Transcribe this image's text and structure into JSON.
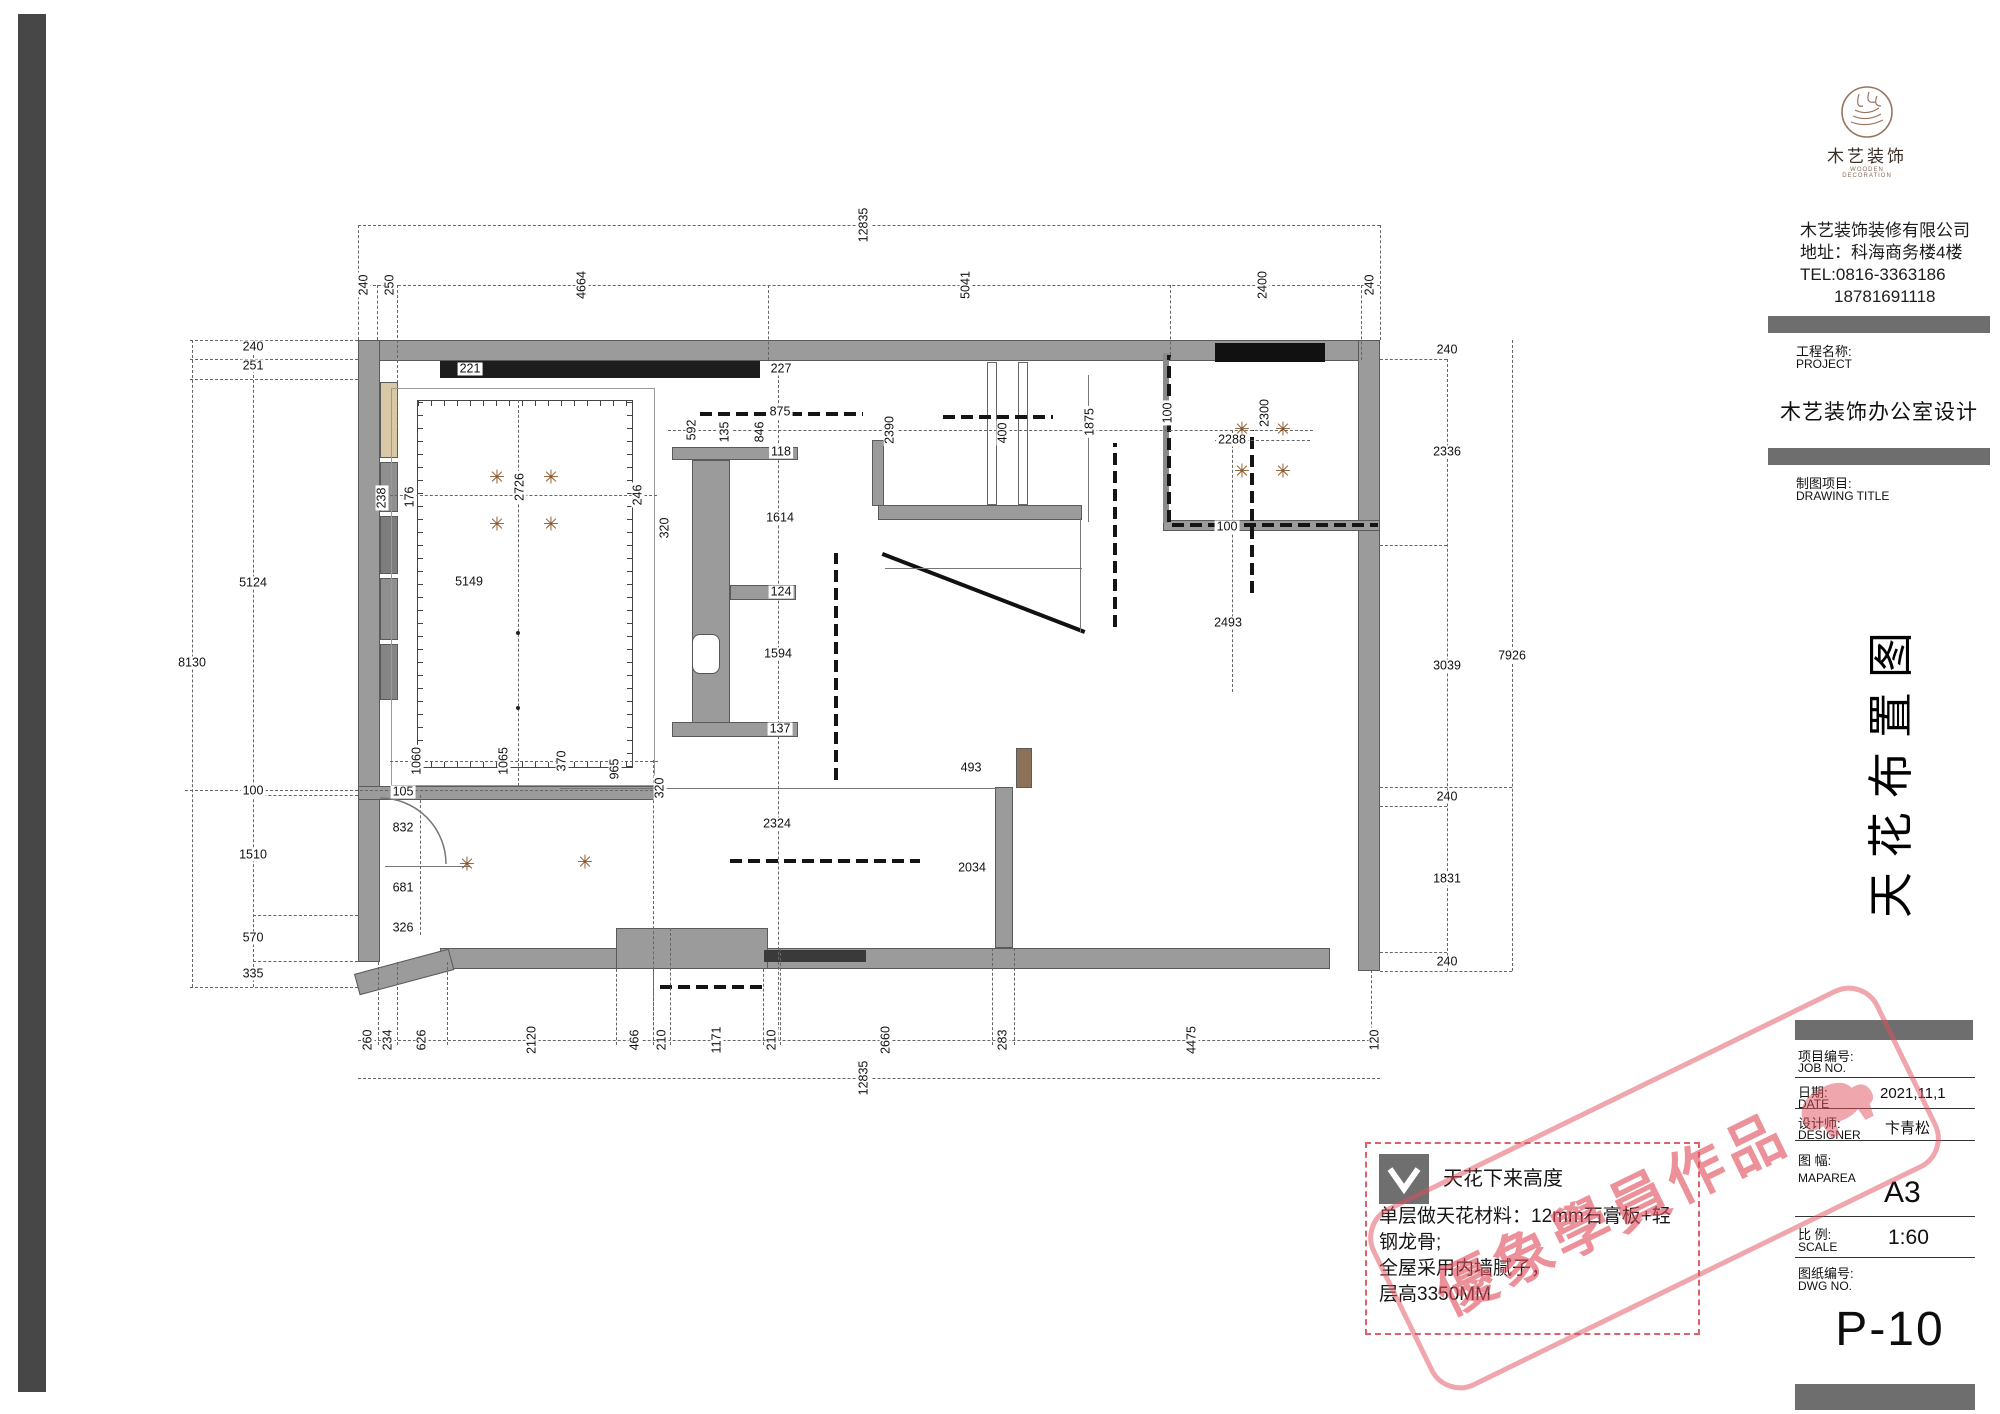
{
  "company": {
    "logo_cn": "木艺装饰",
    "logo_en": "WOODEN DECORATION",
    "full_name": "木艺装饰装修有限公司",
    "address": "地址：科海商务楼4楼",
    "tel": "TEL:0816-3363186",
    "tel2": "18781691118"
  },
  "title_block": {
    "project_label_cn": "工程名称:",
    "project_label_en": "PROJECT",
    "project_name": "木艺装饰办公室设计",
    "drawing_label_cn": "制图项目:",
    "drawing_label_en": "DRAWING TITLE",
    "drawing_title_vertical": "天花布置图",
    "rows": [
      {
        "cn": "项目编号:",
        "en": "JOB NO.",
        "value": ""
      },
      {
        "cn": "日期:",
        "en": "DATE",
        "value": "2021,11,1"
      },
      {
        "cn": "设计师:",
        "en": "DESIGNER",
        "value": "卞青松"
      },
      {
        "cn": "图 幅:",
        "en": "MAPAREA",
        "value": "A3"
      },
      {
        "cn": "比 例:",
        "en": "SCALE",
        "value": "1:60"
      },
      {
        "cn": "图纸编号:",
        "en": "DWG NO.",
        "value": ""
      }
    ],
    "sheet_number": "P-10"
  },
  "legend": {
    "item1": "天花下来高度",
    "note1": "单层做天花材料：12mm石膏板+轻钢龙骨;",
    "note2": "全屋采用内墙腻子，",
    "note3": "层高3350MM"
  },
  "watermark": {
    "text": "優象學員作品"
  },
  "plan": {
    "dims": [
      {
        "t": "12835",
        "x": 864,
        "y": 225,
        "r": 1
      },
      {
        "t": "240",
        "x": 364,
        "y": 285,
        "r": 1
      },
      {
        "t": "250",
        "x": 390,
        "y": 285,
        "r": 1
      },
      {
        "t": "4664",
        "x": 582,
        "y": 285,
        "r": 1
      },
      {
        "t": "5041",
        "x": 966,
        "y": 285,
        "r": 1
      },
      {
        "t": "2400",
        "x": 1263,
        "y": 285,
        "r": 1
      },
      {
        "t": "240",
        "x": 1370,
        "y": 285,
        "r": 1
      },
      {
        "t": "8130",
        "x": 192,
        "y": 663,
        "r": 0
      },
      {
        "t": "240",
        "x": 253,
        "y": 347,
        "r": 0
      },
      {
        "t": "251",
        "x": 253,
        "y": 366,
        "r": 0
      },
      {
        "t": "5124",
        "x": 253,
        "y": 583,
        "r": 0
      },
      {
        "t": "100",
        "x": 253,
        "y": 791,
        "r": 0
      },
      {
        "t": "1510",
        "x": 253,
        "y": 855,
        "r": 0
      },
      {
        "t": "570",
        "x": 253,
        "y": 938,
        "r": 0
      },
      {
        "t": "335",
        "x": 253,
        "y": 974,
        "r": 0
      },
      {
        "t": "7926",
        "x": 1512,
        "y": 656,
        "r": 0
      },
      {
        "t": "240",
        "x": 1447,
        "y": 350,
        "r": 0
      },
      {
        "t": "2336",
        "x": 1447,
        "y": 452,
        "r": 0
      },
      {
        "t": "3039",
        "x": 1447,
        "y": 666,
        "r": 0
      },
      {
        "t": "240",
        "x": 1447,
        "y": 797,
        "r": 0
      },
      {
        "t": "1831",
        "x": 1447,
        "y": 879,
        "r": 0
      },
      {
        "t": "240",
        "x": 1447,
        "y": 962,
        "r": 0
      },
      {
        "t": "260",
        "x": 368,
        "y": 1040,
        "r": 1
      },
      {
        "t": "234",
        "x": 388,
        "y": 1040,
        "r": 1
      },
      {
        "t": "626",
        "x": 422,
        "y": 1040,
        "r": 1
      },
      {
        "t": "2120",
        "x": 532,
        "y": 1040,
        "r": 1
      },
      {
        "t": "466",
        "x": 635,
        "y": 1040,
        "r": 1
      },
      {
        "t": "210",
        "x": 662,
        "y": 1040,
        "r": 1
      },
      {
        "t": "1171",
        "x": 717,
        "y": 1040,
        "r": 1
      },
      {
        "t": "210",
        "x": 772,
        "y": 1040,
        "r": 1
      },
      {
        "t": "2660",
        "x": 886,
        "y": 1040,
        "r": 1
      },
      {
        "t": "283",
        "x": 1003,
        "y": 1040,
        "r": 1
      },
      {
        "t": "4475",
        "x": 1192,
        "y": 1040,
        "r": 1
      },
      {
        "t": "120",
        "x": 1375,
        "y": 1040,
        "r": 1
      },
      {
        "t": "12835",
        "x": 864,
        "y": 1078,
        "r": 1
      },
      {
        "t": "221",
        "x": 470,
        "y": 369,
        "r": 0
      },
      {
        "t": "227",
        "x": 781,
        "y": 369,
        "r": 0
      },
      {
        "t": "875",
        "x": 780,
        "y": 412,
        "r": 0
      },
      {
        "t": "592",
        "x": 692,
        "y": 430,
        "r": 1
      },
      {
        "t": "135",
        "x": 725,
        "y": 432,
        "r": 1
      },
      {
        "t": "846",
        "x": 760,
        "y": 432,
        "r": 1
      },
      {
        "t": "118",
        "x": 781,
        "y": 452,
        "r": 0
      },
      {
        "t": "2390",
        "x": 890,
        "y": 430,
        "r": 1
      },
      {
        "t": "400",
        "x": 1003,
        "y": 433,
        "r": 1
      },
      {
        "t": "1875",
        "x": 1090,
        "y": 422,
        "r": 1
      },
      {
        "t": "100",
        "x": 1168,
        "y": 413,
        "r": 1
      },
      {
        "t": "2300",
        "x": 1265,
        "y": 413,
        "r": 1
      },
      {
        "t": "2288",
        "x": 1232,
        "y": 440,
        "r": 0
      },
      {
        "t": "2726",
        "x": 520,
        "y": 487,
        "r": 1
      },
      {
        "t": "238",
        "x": 382,
        "y": 498,
        "r": 1
      },
      {
        "t": "176",
        "x": 410,
        "y": 497,
        "r": 1
      },
      {
        "t": "246",
        "x": 638,
        "y": 495,
        "r": 1
      },
      {
        "t": "320",
        "x": 665,
        "y": 528,
        "r": 1
      },
      {
        "t": "1614",
        "x": 780,
        "y": 518,
        "r": 0
      },
      {
        "t": "5149",
        "x": 469,
        "y": 582,
        "r": 0
      },
      {
        "t": "124",
        "x": 781,
        "y": 592,
        "r": 0
      },
      {
        "t": "1594",
        "x": 778,
        "y": 654,
        "r": 0
      },
      {
        "t": "100",
        "x": 1227,
        "y": 527,
        "r": 0
      },
      {
        "t": "2493",
        "x": 1228,
        "y": 623,
        "r": 0
      },
      {
        "t": "137",
        "x": 780,
        "y": 729,
        "r": 0
      },
      {
        "t": "1060",
        "x": 417,
        "y": 761,
        "r": 1
      },
      {
        "t": "1065",
        "x": 504,
        "y": 761,
        "r": 1
      },
      {
        "t": "370",
        "x": 562,
        "y": 761,
        "r": 1
      },
      {
        "t": "965",
        "x": 615,
        "y": 769,
        "r": 1
      },
      {
        "t": "320",
        "x": 660,
        "y": 788,
        "r": 1
      },
      {
        "t": "105",
        "x": 403,
        "y": 792,
        "r": 0
      },
      {
        "t": "832",
        "x": 403,
        "y": 828,
        "r": 0
      },
      {
        "t": "681",
        "x": 403,
        "y": 888,
        "r": 0
      },
      {
        "t": "326",
        "x": 403,
        "y": 928,
        "r": 0
      },
      {
        "t": "2324",
        "x": 777,
        "y": 824,
        "r": 0
      },
      {
        "t": "493",
        "x": 971,
        "y": 768,
        "r": 0
      },
      {
        "t": "2034",
        "x": 972,
        "y": 868,
        "r": 0
      }
    ]
  }
}
